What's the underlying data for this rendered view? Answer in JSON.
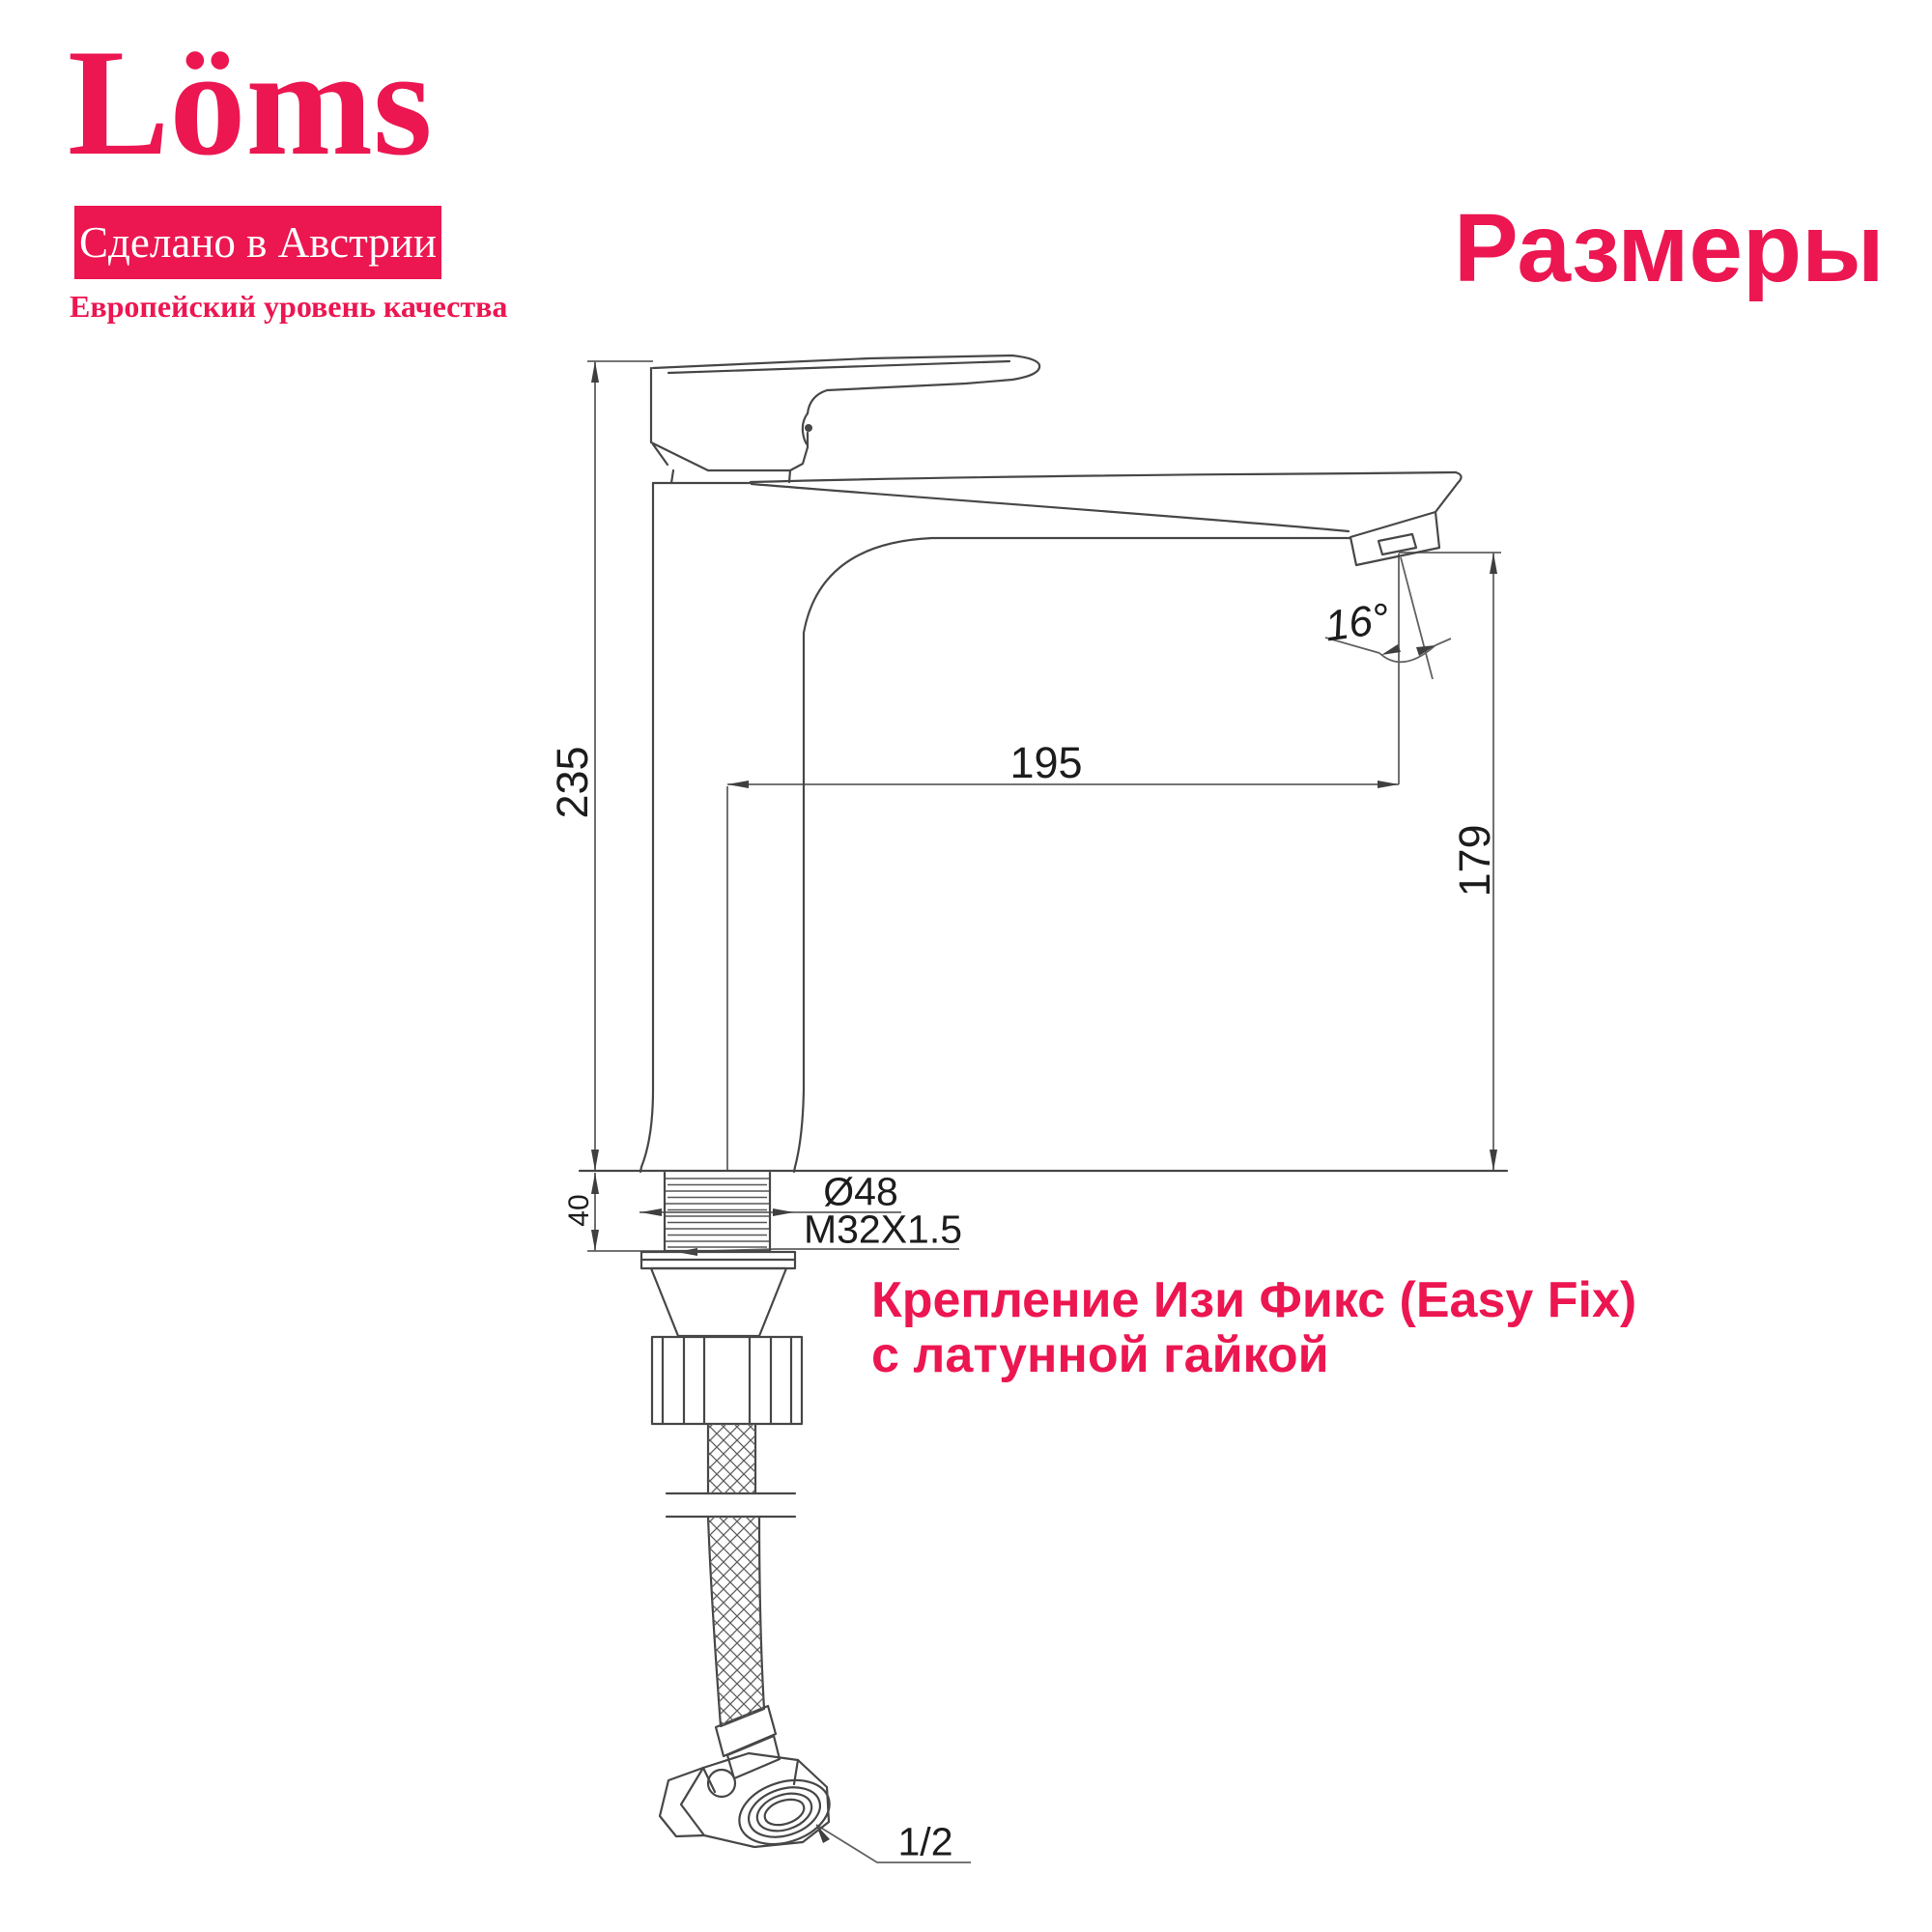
{
  "brand": {
    "logo_text": "Löms",
    "badge_text": "Сделано в Австрии",
    "tagline": "Европейский уровень качества",
    "accent_color": "#EC1651"
  },
  "page": {
    "title": "Размеры"
  },
  "drawing": {
    "description": "faucet-technical-drawing",
    "dimensions": {
      "total_height": "235",
      "spout_reach": "195",
      "spout_height": "179",
      "spout_angle": "16°",
      "base_diameter": "Ø48",
      "mount_thread": "M32X1.5",
      "thread_length": "40",
      "hose_connection": "1/2"
    }
  },
  "annotation": {
    "line1": "Крепление Изи Фикс (Easy Fix)",
    "line2": "с латунной гайкой"
  }
}
